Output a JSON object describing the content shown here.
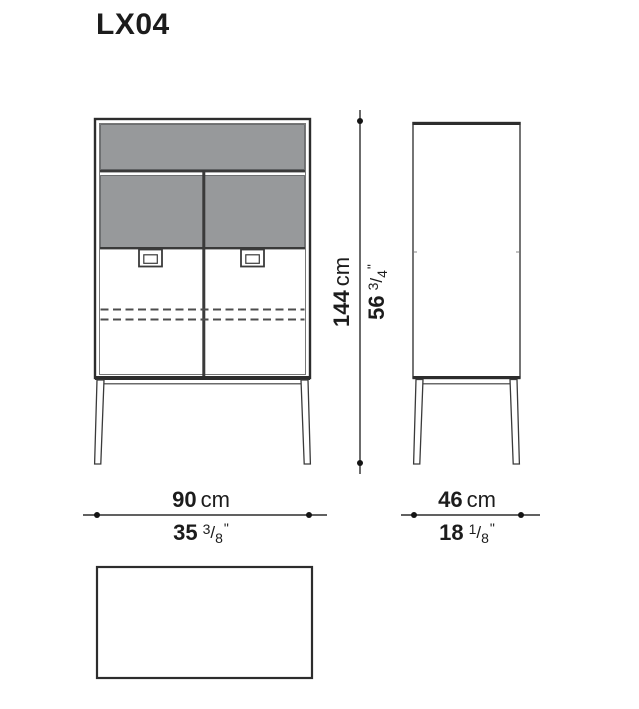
{
  "title": "LX04",
  "glyphs": {
    "fraction_slash": "/"
  },
  "colors": {
    "line": "#2d2d2d",
    "panel_gray": "#97999b",
    "text": "#1c1c1c"
  },
  "dimensions": {
    "height": {
      "metric": "144",
      "metric_unit": "cm",
      "imperial_whole": "56",
      "imperial_frac_num": "3",
      "imperial_frac_den": "4",
      "imperial_unit": "\""
    },
    "width": {
      "metric": "90",
      "metric_unit": "cm",
      "imperial_whole": "35",
      "imperial_frac_num": "3",
      "imperial_frac_den": "8",
      "imperial_unit": "\""
    },
    "depth": {
      "metric": "46",
      "metric_unit": "cm",
      "imperial_whole": "18",
      "imperial_frac_num": "1",
      "imperial_frac_den": "8",
      "imperial_unit": "\""
    }
  }
}
